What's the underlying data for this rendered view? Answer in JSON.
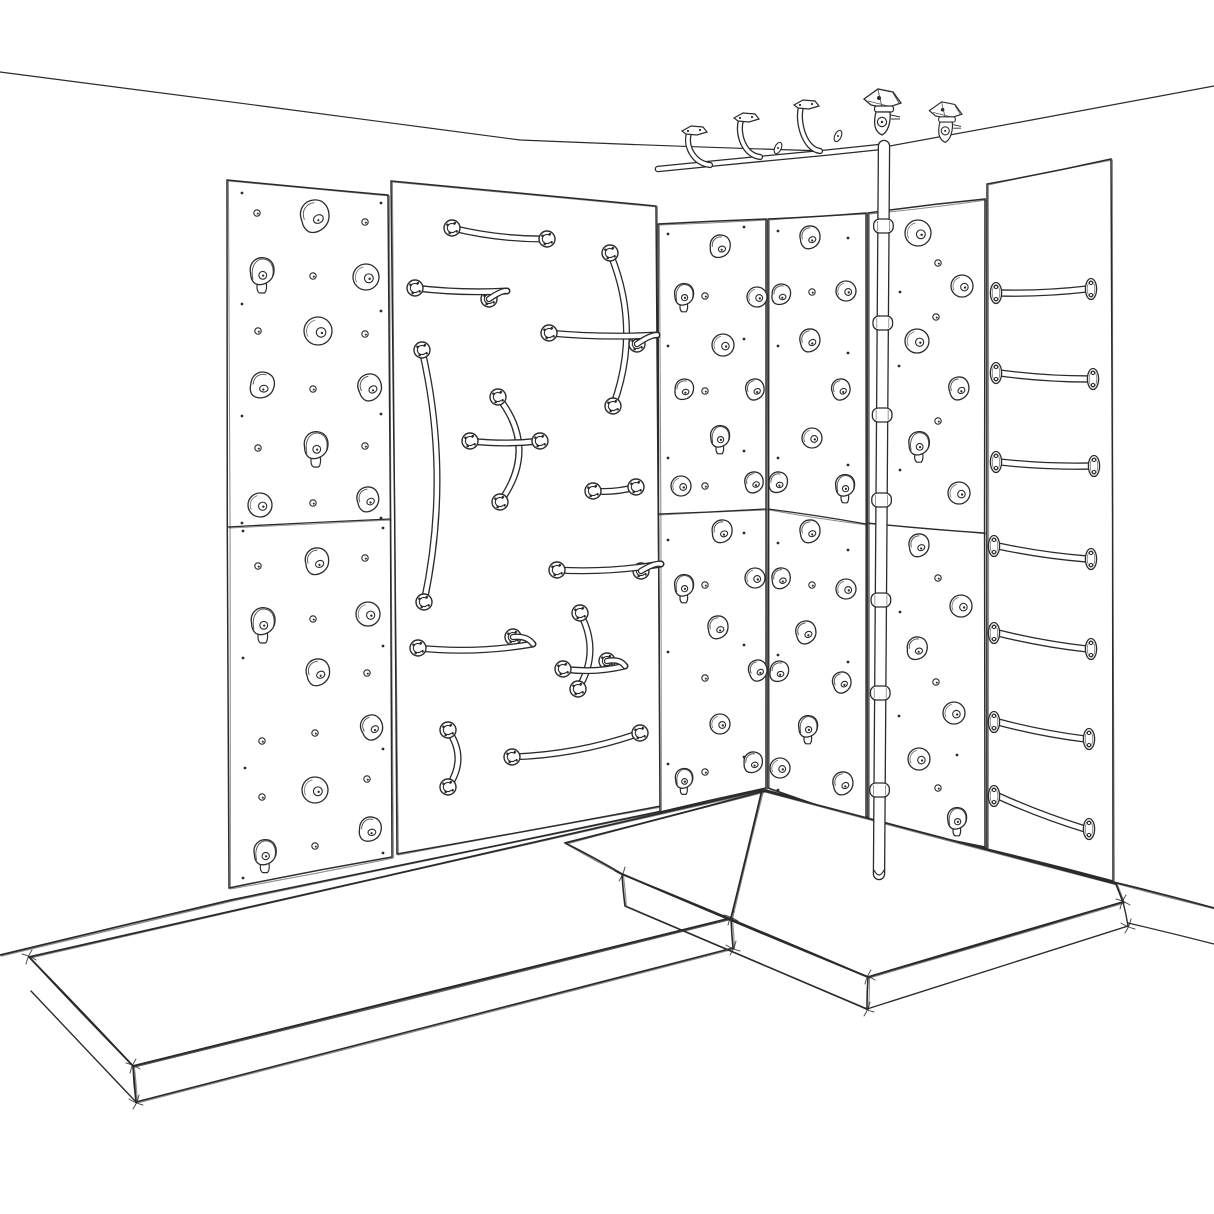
{
  "scene": {
    "title": "Hand-drawn sketch of a corner kids climbing room: hold panels, grab-bar panel, wall ladder, ceiling rail with hangers, swivel-mounted fire pole and crash mats",
    "desc": "Black ink sketch on white. Left wall: climbing hold panels and a grab-bar panel. Right wall: climbing hold panels, vertical fire pole with collar joints, and a rung ladder panel. Two thick crash mats on the floor. Ceiling-mounted traverse rail with J-hangers and two swivel pole mounts.",
    "paper": "#ffffff",
    "ink": "#2b2b2b",
    "width": 1214,
    "height": 1214
  },
  "ceiling": {
    "left": [
      [
        0,
        72
      ],
      [
        520,
        140
      ],
      [
        857,
        152
      ]
    ],
    "right": [
      [
        857,
        152
      ],
      [
        1214,
        86
      ]
    ]
  },
  "bases": {
    "left": [
      [
        0,
        955
      ],
      [
        231,
        900
      ],
      [
        763,
        790
      ]
    ],
    "right": [
      [
        765,
        790
      ],
      [
        1113,
        882
      ],
      [
        1214,
        908
      ]
    ],
    "ext": [
      [
        1128,
        923
      ],
      [
        1214,
        944
      ]
    ]
  },
  "panels": [
    {
      "name": "hold-panel-left-column",
      "pts": [
        [
          227,
          180
        ],
        [
          388,
          195
        ],
        [
          392,
          857
        ],
        [
          229,
          888
        ]
      ],
      "split": [
        [
          228,
          527
        ],
        [
          390,
          519
        ]
      ]
    },
    {
      "name": "grab-bar-panel",
      "pts": [
        [
          391,
          181
        ],
        [
          656,
          206
        ],
        [
          661,
          806
        ],
        [
          397,
          854
        ]
      ]
    },
    {
      "name": "hold-panel-corner-left",
      "pts": [
        [
          658,
          224
        ],
        [
          766,
          219
        ],
        [
          766,
          788
        ],
        [
          660,
          812
        ]
      ],
      "split": [
        [
          658,
          514
        ],
        [
          766,
          509
        ]
      ]
    },
    {
      "name": "hold-panel-corner-right",
      "pts": [
        [
          768,
          219
        ],
        [
          866,
          213
        ],
        [
          866,
          822
        ],
        [
          768,
          788
        ]
      ],
      "split": [
        [
          768,
          509
        ],
        [
          866,
          524
        ]
      ]
    },
    {
      "name": "hold-panel-right-wall",
      "pts": [
        [
          868,
          213
        ],
        [
          985,
          199
        ],
        [
          985,
          847
        ],
        [
          868,
          823
        ]
      ],
      "split": [
        [
          868,
          523
        ],
        [
          985,
          533
        ]
      ]
    },
    {
      "name": "ladder-panel",
      "pts": [
        [
          987,
          184
        ],
        [
          1111,
          159
        ],
        [
          1113,
          881
        ],
        [
          987,
          849
        ]
      ]
    }
  ],
  "holds": [
    [
      "t",
      315,
      217,
      17,
      -10
    ],
    [
      "s",
      262,
      272,
      15,
      0
    ],
    [
      "r",
      366,
      277,
      13,
      0
    ],
    [
      "r",
      318,
      331,
      14,
      0
    ],
    [
      "t",
      262,
      386,
      14,
      15
    ],
    [
      "t",
      370,
      388,
      14,
      -15
    ],
    [
      "s",
      316,
      446,
      15,
      0
    ],
    [
      "r",
      260,
      505,
      12,
      0
    ],
    [
      "t",
      368,
      500,
      13,
      -10
    ],
    [
      "t",
      317,
      562,
      14,
      -5
    ],
    [
      "s",
      263,
      622,
      15,
      0
    ],
    [
      "r",
      368,
      614,
      12,
      0
    ],
    [
      "t",
      318,
      673,
      14,
      -8
    ],
    [
      "t",
      372,
      728,
      13,
      -20
    ],
    [
      "r",
      315,
      790,
      13,
      0
    ],
    [
      "t",
      370,
      830,
      13,
      10
    ],
    [
      "s",
      265,
      853,
      14,
      0
    ],
    [
      "t",
      720,
      247,
      12,
      5
    ],
    [
      "s",
      684,
      295,
      12,
      0
    ],
    [
      "r",
      757,
      297,
      10,
      0
    ],
    [
      "r",
      723,
      345,
      11,
      0
    ],
    [
      "t",
      684,
      390,
      11,
      10
    ],
    [
      "t",
      755,
      390,
      11,
      -10
    ],
    [
      "s",
      720,
      437,
      12,
      0
    ],
    [
      "r",
      681,
      486,
      10,
      0
    ],
    [
      "t",
      754,
      483,
      11,
      -5
    ],
    [
      "t",
      722,
      532,
      12,
      0
    ],
    [
      "s",
      684,
      586,
      12,
      0
    ],
    [
      "r",
      755,
      578,
      10,
      0
    ],
    [
      "t",
      718,
      628,
      12,
      -5
    ],
    [
      "t",
      758,
      671,
      11,
      -15
    ],
    [
      "r",
      720,
      724,
      10,
      0
    ],
    [
      "s",
      684,
      779,
      11,
      0
    ],
    [
      "t",
      753,
      763,
      11,
      5
    ],
    [
      "t",
      810,
      238,
      12,
      -5
    ],
    [
      "t",
      781,
      295,
      11,
      10
    ],
    [
      "r",
      846,
      291,
      10,
      0
    ],
    [
      "t",
      810,
      341,
      12,
      -8
    ],
    [
      "t",
      841,
      390,
      11,
      -12
    ],
    [
      "r",
      812,
      438,
      10,
      0
    ],
    [
      "t",
      778,
      483,
      11,
      8
    ],
    [
      "s",
      845,
      486,
      12,
      0
    ],
    [
      "t",
      810,
      532,
      12,
      -5
    ],
    [
      "t",
      781,
      579,
      11,
      0
    ],
    [
      "r",
      846,
      589,
      10,
      0
    ],
    [
      "t",
      806,
      633,
      12,
      -10
    ],
    [
      "t",
      779,
      672,
      11,
      12
    ],
    [
      "t",
      842,
      683,
      11,
      -15
    ],
    [
      "s",
      808,
      727,
      12,
      0
    ],
    [
      "r",
      780,
      768,
      10,
      0
    ],
    [
      "t",
      843,
      784,
      12,
      -8
    ],
    [
      "r",
      918,
      233,
      13,
      0
    ],
    [
      "r",
      962,
      286,
      11,
      0
    ],
    [
      "r",
      917,
      341,
      12,
      0
    ],
    [
      "t",
      959,
      389,
      12,
      -10
    ],
    [
      "s",
      919,
      444,
      13,
      0
    ],
    [
      "r",
      959,
      493,
      11,
      0
    ],
    [
      "t",
      919,
      546,
      12,
      -5
    ],
    [
      "r",
      961,
      606,
      11,
      0
    ],
    [
      "t",
      917,
      649,
      12,
      5
    ],
    [
      "r",
      954,
      713,
      11,
      0
    ],
    [
      "r",
      919,
      759,
      11,
      0
    ],
    [
      "s",
      957,
      819,
      12,
      0
    ]
  ],
  "dots_open": [
    [
      257,
      213
    ],
    [
      365,
      222
    ],
    [
      313,
      276
    ],
    [
      258,
      331
    ],
    [
      365,
      334
    ],
    [
      313,
      389
    ],
    [
      258,
      448
    ],
    [
      365,
      446
    ],
    [
      313,
      503
    ],
    [
      258,
      566
    ],
    [
      365,
      558
    ],
    [
      313,
      619
    ],
    [
      262,
      741
    ],
    [
      315,
      733
    ],
    [
      367,
      673
    ],
    [
      262,
      797
    ],
    [
      367,
      779
    ],
    [
      315,
      846
    ],
    [
      705,
      296
    ],
    [
      705,
      391
    ],
    [
      705,
      486
    ],
    [
      705,
      585
    ],
    [
      705,
      678
    ],
    [
      705,
      772
    ],
    [
      812,
      292
    ],
    [
      812,
      585
    ],
    [
      938,
      263
    ],
    [
      936,
      317
    ],
    [
      938,
      421
    ],
    [
      938,
      578
    ],
    [
      936,
      682
    ],
    [
      938,
      788
    ]
  ],
  "dots_tiny": [
    [
      242,
      193
    ],
    [
      381,
      203
    ],
    [
      242,
      304
    ],
    [
      381,
      311
    ],
    [
      242,
      416
    ],
    [
      381,
      414
    ],
    [
      242,
      523
    ],
    [
      381,
      518
    ],
    [
      243,
      531
    ],
    [
      383,
      528
    ],
    [
      243,
      658
    ],
    [
      383,
      646
    ],
    [
      245,
      768
    ],
    [
      383,
      749
    ],
    [
      243,
      878
    ],
    [
      383,
      853
    ],
    [
      668,
      234
    ],
    [
      744,
      227
    ],
    [
      668,
      346
    ],
    [
      744,
      339
    ],
    [
      668,
      458
    ],
    [
      744,
      451
    ],
    [
      668,
      540
    ],
    [
      744,
      533
    ],
    [
      668,
      652
    ],
    [
      744,
      645
    ],
    [
      668,
      764
    ],
    [
      744,
      757
    ],
    [
      778,
      231
    ],
    [
      848,
      238
    ],
    [
      778,
      346
    ],
    [
      848,
      353
    ],
    [
      778,
      458
    ],
    [
      848,
      465
    ],
    [
      778,
      543
    ],
    [
      848,
      550
    ],
    [
      778,
      655
    ],
    [
      848,
      662
    ],
    [
      778,
      790
    ],
    [
      848,
      775
    ],
    [
      900,
      292
    ],
    [
      899,
      366
    ],
    [
      900,
      470
    ],
    [
      900,
      612
    ],
    [
      899,
      716
    ],
    [
      957,
      755
    ]
  ],
  "bars": [
    {
      "a": [
        452,
        228
      ],
      "b": [
        547,
        239
      ],
      "bow": 3
    },
    {
      "a": [
        415,
        288
      ],
      "b": [
        507,
        291
      ],
      "bow": 2,
      "hook": [
        489,
        299
      ]
    },
    {
      "a": [
        610,
        253
      ],
      "b": [
        613,
        406
      ],
      "bow": -15
    },
    {
      "a": [
        549,
        333
      ],
      "b": [
        657,
        335
      ],
      "bow": 2,
      "hook": [
        637,
        344
      ]
    },
    {
      "a": [
        422,
        350
      ],
      "b": [
        424,
        602
      ],
      "bow": -14
    },
    {
      "a": [
        498,
        397
      ],
      "b": [
        500,
        502
      ],
      "bow": -20
    },
    {
      "a": [
        470,
        441
      ],
      "b": [
        540,
        441
      ],
      "bow": 2
    },
    {
      "a": [
        593,
        491
      ],
      "b": [
        636,
        487
      ],
      "bow": 2
    },
    {
      "a": [
        557,
        570
      ],
      "b": [
        661,
        564
      ],
      "bow": 3,
      "hook": [
        641,
        571
      ]
    },
    {
      "a": [
        580,
        613
      ],
      "b": [
        578,
        689
      ],
      "bow": -11
    },
    {
      "a": [
        563,
        669
      ],
      "b": [
        625,
        666
      ],
      "bow": 3,
      "hook": [
        607,
        661
      ]
    },
    {
      "a": [
        418,
        648
      ],
      "b": [
        533,
        644
      ],
      "bow": 4,
      "hook": [
        513,
        637
      ]
    },
    {
      "a": [
        448,
        730
      ],
      "b": [
        448,
        787
      ],
      "bow": -10
    },
    {
      "a": [
        512,
        757
      ],
      "b": [
        640,
        733
      ],
      "bow": 5
    }
  ],
  "rungs": [
    {
      "a": [
        997,
        293
      ],
      "b": [
        1090,
        289
      ]
    },
    {
      "a": [
        997,
        373
      ],
      "b": [
        1092,
        379
      ]
    },
    {
      "a": [
        997,
        462
      ],
      "b": [
        1093,
        466
      ]
    },
    {
      "a": [
        995,
        546
      ],
      "b": [
        1090,
        559
      ]
    },
    {
      "a": [
        995,
        633
      ],
      "b": [
        1090,
        649
      ]
    },
    {
      "a": [
        995,
        722
      ],
      "b": [
        1088,
        739
      ]
    },
    {
      "a": [
        995,
        796
      ],
      "b": [
        1088,
        829
      ]
    }
  ],
  "rail": {
    "pts": [
      [
        658,
        169
      ],
      [
        770,
        158
      ],
      [
        880,
        147
      ]
    ]
  },
  "hangers": {
    "plates": [
      [
        694,
        130
      ],
      [
        746,
        117
      ],
      [
        806,
        104
      ]
    ],
    "drops": [
      [
        710,
        165
      ],
      [
        760,
        157
      ],
      [
        820,
        151
      ]
    ],
    "tplates": [
      [
        778,
        148
      ],
      [
        838,
        136
      ]
    ]
  },
  "mounts": [
    {
      "x": 884,
      "y": 146,
      "s": 1
    },
    {
      "x": 947,
      "y": 152,
      "s": 0.88
    }
  ],
  "pole": {
    "top": [
      884,
      146
    ],
    "bottom": [
      879,
      874
    ],
    "width": 12.5,
    "collars": [
      226,
      323,
      415,
      500,
      600,
      693,
      790
    ]
  },
  "mats": {
    "left": {
      "top": [
        [
          29,
          957
        ],
        [
          762,
          790
        ],
        [
          731,
          918
        ],
        [
          133,
          1066
        ]
      ],
      "front": [
        [
          133,
          1066
        ],
        [
          731,
          918
        ],
        [
          733,
          948
        ],
        [
          136,
          1102
        ]
      ],
      "side": [
        [
          29,
          957
        ],
        [
          133,
          1066
        ],
        [
          136,
          1102
        ],
        [
          31,
          991
        ]
      ],
      "seam": [
        [
          762,
          790
        ],
        [
          731,
          918
        ]
      ]
    },
    "right": {
      "top": [
        [
          565,
          843
        ],
        [
          764,
          791
        ],
        [
          1116,
          884
        ],
        [
          1123,
          902
        ],
        [
          868,
          977
        ],
        [
          622,
          874
        ]
      ],
      "front": [
        [
          622,
          874
        ],
        [
          868,
          977
        ],
        [
          867,
          1009
        ],
        [
          625,
          906
        ]
      ],
      "side": [
        [
          868,
          977
        ],
        [
          1123,
          902
        ],
        [
          1128,
          926
        ],
        [
          867,
          1009
        ]
      ]
    },
    "ticks": [
      [
        731,
        918
      ],
      [
        733,
        948
      ],
      [
        868,
        977
      ],
      [
        867,
        1009
      ],
      [
        1123,
        902
      ],
      [
        1128,
        926
      ],
      [
        133,
        1066
      ],
      [
        136,
        1102
      ],
      [
        29,
        957
      ],
      [
        622,
        874
      ]
    ]
  }
}
